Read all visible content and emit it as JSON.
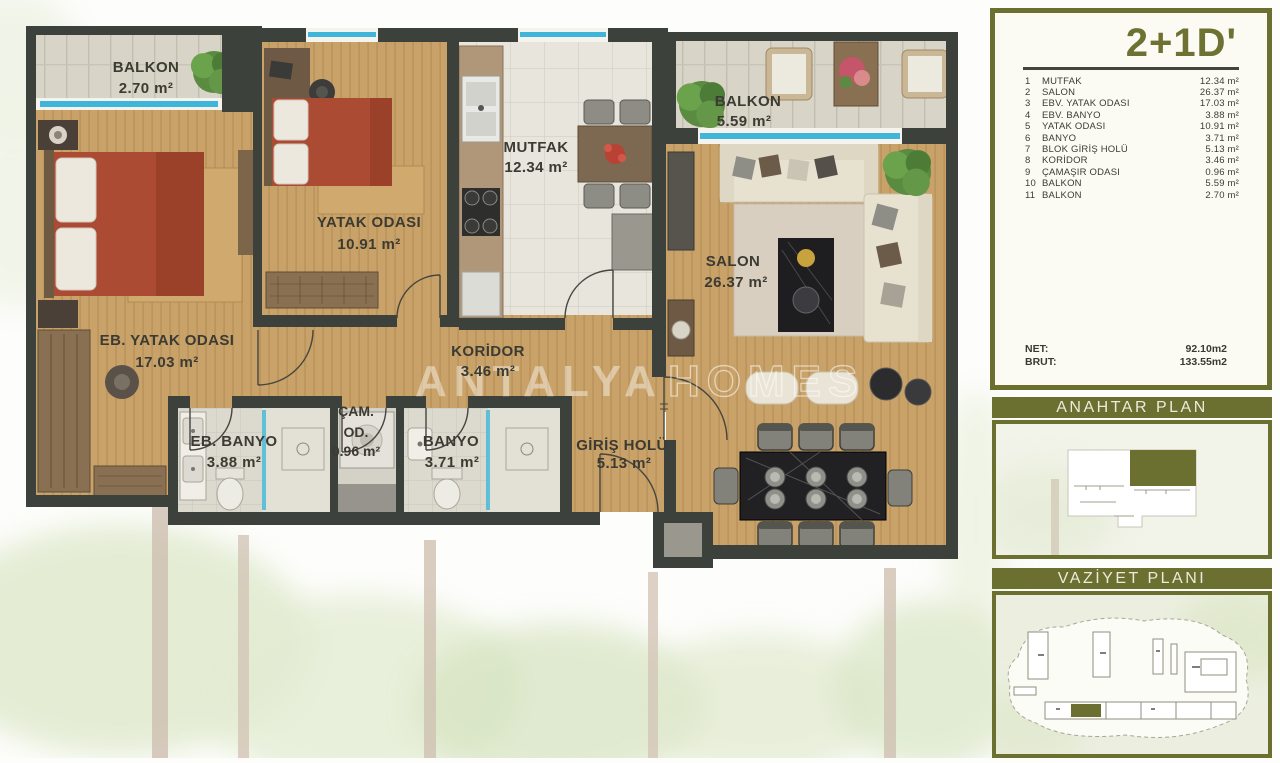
{
  "watermark": {
    "bold": "ANTALYA",
    "outline": "HOMES"
  },
  "plan": {
    "rooms": {
      "balkon1": {
        "name": "BALKON",
        "area": "2.70 m²"
      },
      "eb_yatak": {
        "name": "EB. YATAK ODASI",
        "area": "17.03 m²"
      },
      "yatak": {
        "name": "YATAK ODASI",
        "area": "10.91 m²"
      },
      "mutfak": {
        "name": "MUTFAK",
        "area": "12.34 m²"
      },
      "balkon2": {
        "name": "BALKON",
        "area": "5.59 m²"
      },
      "salon": {
        "name": "SALON",
        "area": "26.37 m²"
      },
      "koridor": {
        "name": "KORİDOR",
        "area": "3.46 m²"
      },
      "eb_banyo": {
        "name": "EB. BANYO",
        "area": "3.88 m²"
      },
      "cam_od": {
        "line1": "ÇAM.",
        "line2": "OD.",
        "area": "0.96 m²"
      },
      "banyo": {
        "name": "BANYO",
        "area": "3.71 m²"
      },
      "giris": {
        "name": "GİRİŞ HOLÜ",
        "area": "5.13 m²"
      }
    }
  },
  "sidebar": {
    "title": "2+1D'",
    "legend": [
      {
        "no": "1",
        "name": "MUTFAK",
        "area": "12.34 m²"
      },
      {
        "no": "2",
        "name": "SALON",
        "area": "26.37 m²"
      },
      {
        "no": "3",
        "name": "EBV. YATAK ODASI",
        "area": "17.03 m²"
      },
      {
        "no": "4",
        "name": "EBV. BANYO",
        "area": "3.88 m²"
      },
      {
        "no": "5",
        "name": "YATAK ODASI",
        "area": "10.91 m²"
      },
      {
        "no": "6",
        "name": "BANYO",
        "area": "3.71 m²"
      },
      {
        "no": "7",
        "name": "BLOK GİRİŞ HOLÜ",
        "area": "5.13 m²"
      },
      {
        "no": "8",
        "name": "KORİDOR",
        "area": "3.46 m²"
      },
      {
        "no": "9",
        "name": "ÇAMAŞIR ODASI",
        "area": "0.96 m²"
      },
      {
        "no": "10",
        "name": "BALKON",
        "area": "5.59 m²"
      },
      {
        "no": "11",
        "name": "BALKON",
        "area": "2.70 m²"
      }
    ],
    "net_label": "NET:",
    "net_value": "92.10m2",
    "brut_label": "BRUT:",
    "brut_value": "133.55m2",
    "key_plan_title": "ANAHTAR PLAN",
    "site_plan_title": "VAZİYET PLANI"
  },
  "colors": {
    "olive": "#6b7030",
    "wall": "#3d413b",
    "wood": "#c8a268",
    "window_glass": "#3fb6d9",
    "bed_red": "#ac4b33",
    "panel_bg": "#fbfaf3"
  }
}
